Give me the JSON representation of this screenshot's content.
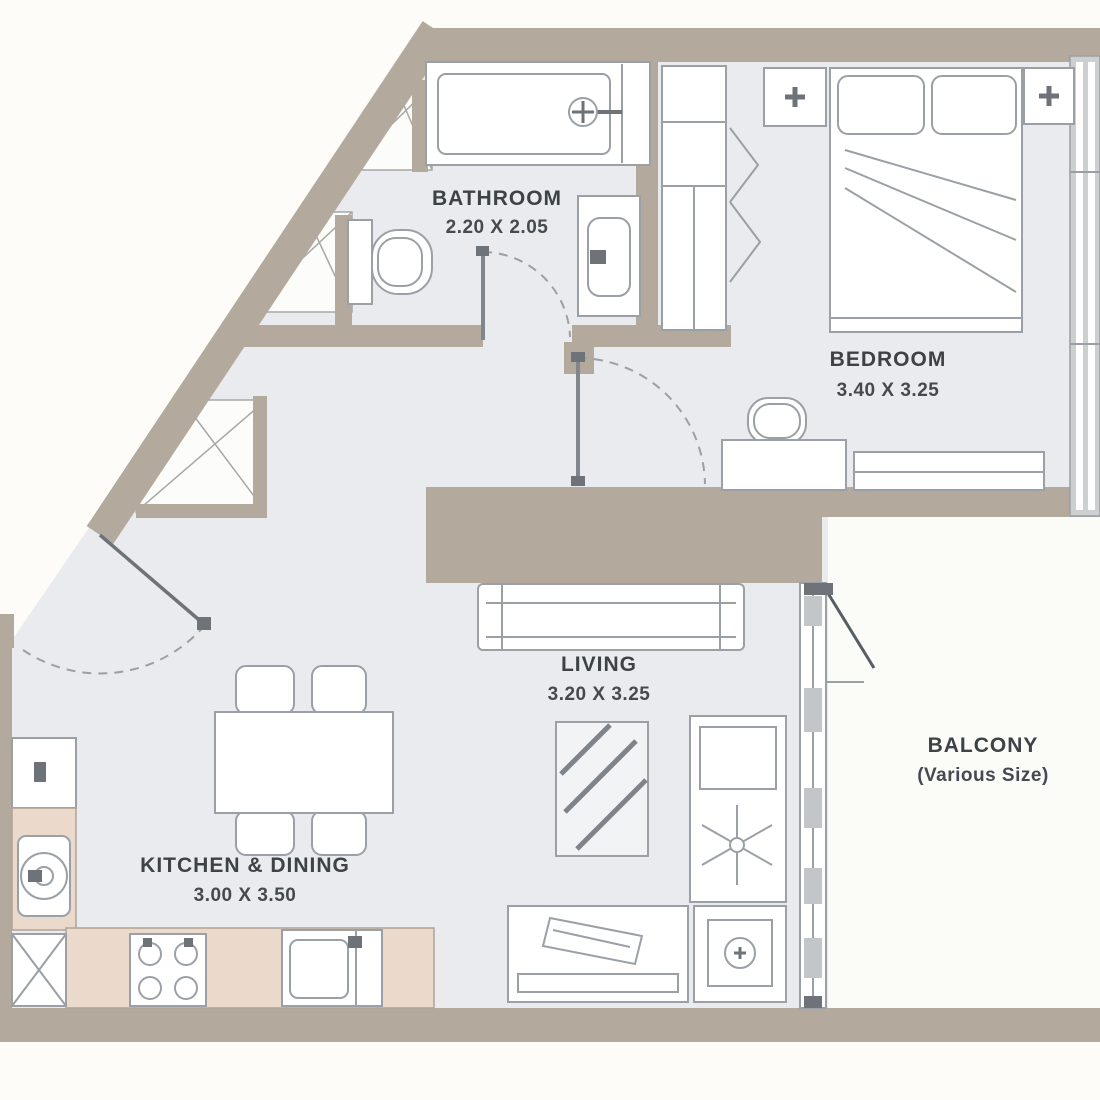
{
  "title": "Apartment Floor Plan",
  "rooms": {
    "bathroom": {
      "label": "BATHROOM",
      "dims": "2.20 X 2.05"
    },
    "bedroom": {
      "label": "BEDROOM",
      "dims": "3.40 X 3.25"
    },
    "living": {
      "label": "LIVING",
      "dims": "3.20 X 3.25"
    },
    "balcony": {
      "label": "BALCONY",
      "dims": "(Various Size)"
    },
    "kitchen_dining": {
      "label": "KITCHEN & DINING",
      "dims": "3.00 X 3.50"
    }
  },
  "colors": {
    "wall": "#b3aa9d",
    "floor": "#e9ebee",
    "balcony_floor": "#fbfbf8",
    "counter": "#ebdacc",
    "line": "#9aa0a6",
    "text": "#3d4247"
  }
}
